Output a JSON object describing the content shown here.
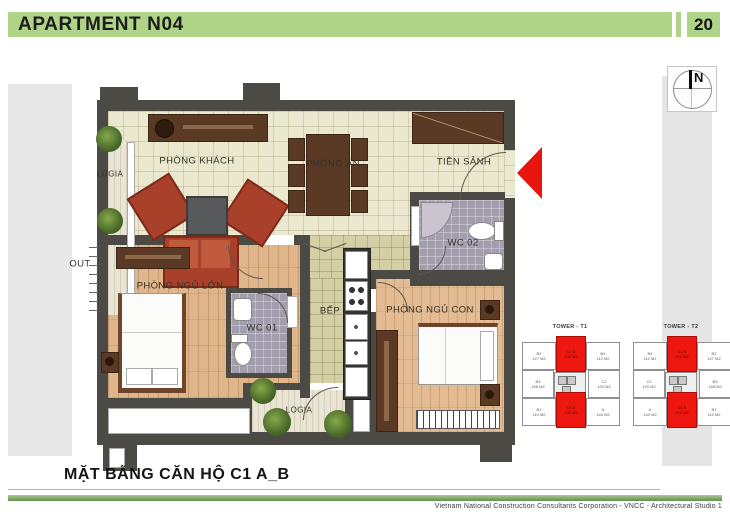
{
  "header": {
    "title": "APARTMENT N04",
    "page_number": "20"
  },
  "plan": {
    "caption": "MẶT BẰNG CĂN HỘ C1 A_B",
    "north_label": "N",
    "rooms": {
      "living": "PHÒNG KHÁCH",
      "dining": "PHÒNG ĂN",
      "hall": "TIỀN SẢNH",
      "logia_left": "LOGIA",
      "logia_bottom": "LOGIA",
      "master_bedroom": "PHÒNG NGỦ LỚN",
      "child_bedroom": "PHÒNG NGỦ CON",
      "kitchen": "BẾP",
      "wc1": "WC 01",
      "wc2": "WC 02",
      "out": "OUT"
    }
  },
  "towers": {
    "t1": {
      "title": "TOWER - T1",
      "units": [
        {
          "label": "B2",
          "area": "127 M2"
        },
        {
          "label": "C1 B",
          "area": "100 M2"
        },
        {
          "label": "B4",
          "area": "112 M2"
        },
        {
          "label": "B3",
          "area": "158 M2"
        },
        {
          "label": "C2",
          "area": "120 M2"
        },
        {
          "label": "B1",
          "area": "110 M2"
        },
        {
          "label": "C1 A",
          "area": "100 M2"
        },
        {
          "label": "A",
          "area": "140 M2"
        }
      ]
    },
    "t2": {
      "title": "TOWER - T2",
      "units": [
        {
          "label": "B4",
          "area": "112 M2"
        },
        {
          "label": "C1 B",
          "area": "100 M2"
        },
        {
          "label": "B2",
          "area": "127 M2"
        },
        {
          "label": "C2",
          "area": "120 M2"
        },
        {
          "label": "B3",
          "area": "158 M2"
        },
        {
          "label": "A",
          "area": "140 M2"
        },
        {
          "label": "C1 A",
          "area": "100 M2"
        },
        {
          "label": "B1",
          "area": "110 M2"
        }
      ]
    }
  },
  "footer": {
    "credit": "Vietnam National Construction Consultants Corporation - VNCC - Architectural Studio 1"
  },
  "colors": {
    "accent_green": "#afd488",
    "highlight_red": "#ee1710",
    "wall": "#4b4a45"
  }
}
